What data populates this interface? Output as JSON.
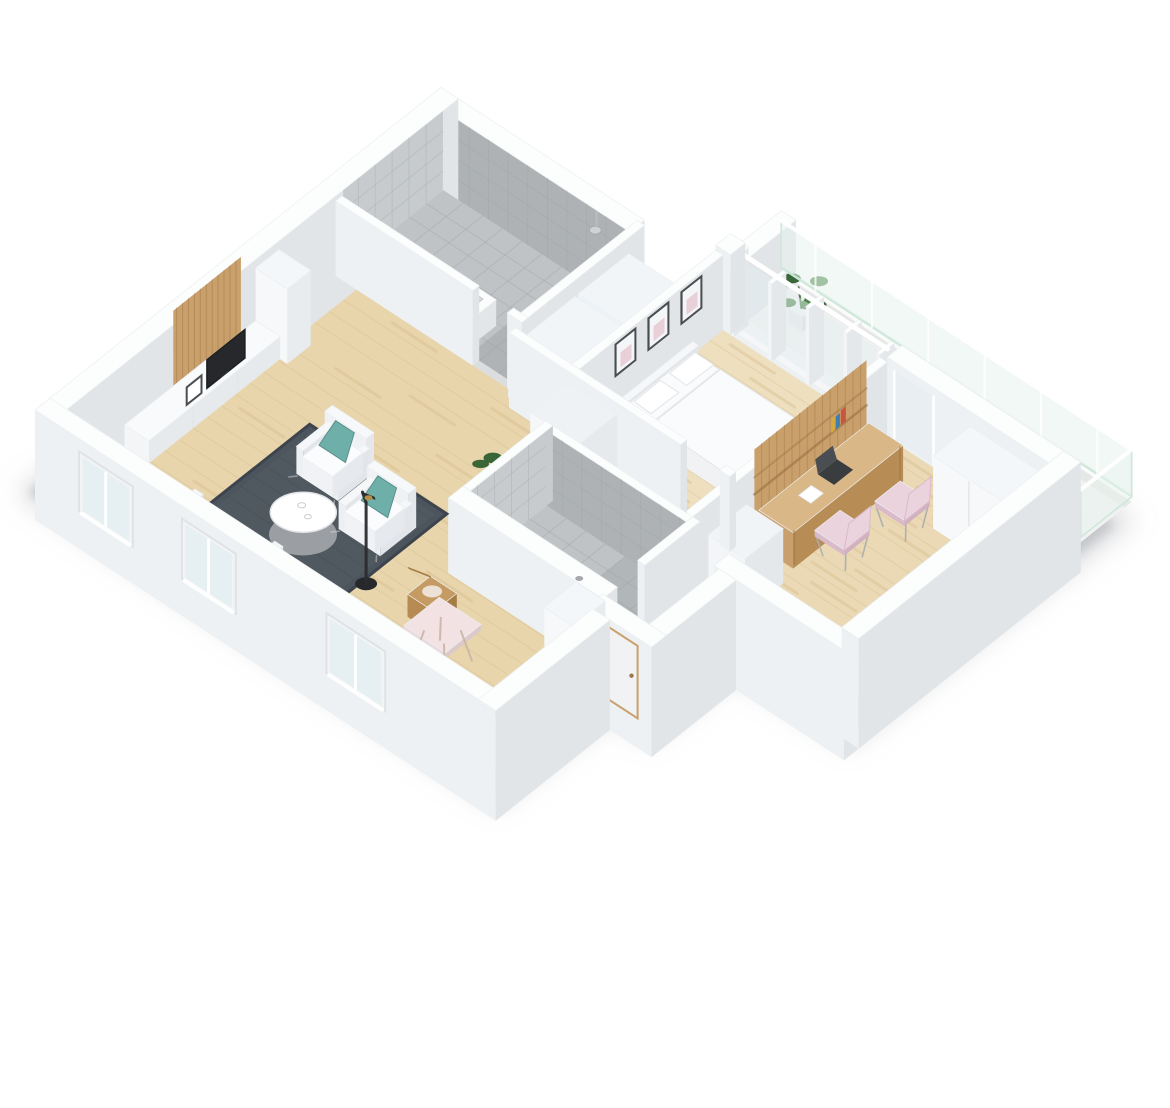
{
  "page": {
    "background": "#ffffff",
    "type": "3d-floor-plan-render",
    "view": "isometric dollhouse cutaway, white exterior walls, no text",
    "subject": "3D isometric floor plan render of a one-bedroom apartment with balcony"
  },
  "palette": {
    "wallTop": "#fcfdfd",
    "wallFrontLight": "#f7f8f9",
    "wallFront": "#eef1f3",
    "wallSide": "#e1e5e8",
    "wallDeep": "#d4d8db",
    "woodBedroom": "#eedfbf",
    "woodOffice": "#ebd9b5",
    "woodHall": "#e9d5ac",
    "woodNook": "#f2e8d0",
    "plankSeam": "#d8c194",
    "plankStreak": "#d2b684",
    "tileFloor": "#bfc3c5",
    "tileFloorDark": "#a9adaf",
    "tileWall": "#c7cbcd",
    "tileWallDark": "#aeb2b4",
    "tileLine": "#9c9fa1",
    "balconyFloor": "#f0f1f0",
    "glass": "#e8f3ee",
    "glassEdge": "#cde7d8",
    "windowGlass": "#e4edf0",
    "rug": "#4c545d",
    "rugDark": "#3d444d",
    "rugLight": "#5b636c",
    "teal": "#6fafa9",
    "tealDark": "#588f8a",
    "mint": "#d9ecdc",
    "paleBlue": "#cfe0ea",
    "pink": "#ebd3dd",
    "pinkShade": "#d9bac9",
    "oak": "#c9a06b",
    "oakDark": "#9e7847",
    "oakLight": "#d9b787",
    "chairWood": "#c59a63",
    "chairWoodDark": "#a57c44",
    "white": "#ffffff",
    "softWhite": "#f4f6f7",
    "bedTop": "#fafbfc",
    "bedShade": "#e9ebef",
    "linen": "#f1f2f4",
    "dark": "#26282b",
    "charcoal": "#3a3d40",
    "brass": "#b98f45",
    "cooktop": "#5d6165",
    "plant": "#44813f",
    "plantDark": "#2e6030",
    "plantStem": "#3c6d38",
    "pot": "#f3f4f4",
    "shadow": "#a7abb0",
    "frameBorder": "#4a4d50",
    "artPink": "#e5c6cf"
  },
  "rooms": [
    {
      "id": "balcony",
      "label": "Balcony",
      "floor": "white concrete"
    },
    {
      "id": "bedroom",
      "label": "Bedroom",
      "floor": "light wood"
    },
    {
      "id": "office",
      "label": "Home office",
      "floor": "light wood"
    },
    {
      "id": "bathroom",
      "label": "Bathroom",
      "floor": "gray tile"
    },
    {
      "id": "shower-room",
      "label": "Shower room",
      "floor": "gray tile"
    },
    {
      "id": "hallway",
      "label": "Hallway",
      "floor": "light wood"
    },
    {
      "id": "closet-nook",
      "label": "Closet nook",
      "floor": "light wood"
    },
    {
      "id": "living-room",
      "label": "Living room",
      "floor": "light wood"
    },
    {
      "id": "kitchen-dining",
      "label": "Kitchen / dining",
      "floor": "light wood"
    },
    {
      "id": "entry-corridor",
      "label": "Entry corridor",
      "floor": "light wood"
    }
  ],
  "furnishings": {
    "balcony": [
      "glass-railing",
      "potted-plant"
    ],
    "bedroom": [
      "double-bed",
      "white-duvet",
      "pillows",
      "wall-frames",
      "window-wall"
    ],
    "office": [
      "wood-desk",
      "slat-shelf-panel",
      "pink-chair",
      "pink-chair",
      "white-wardrobe",
      "white-cabinet"
    ],
    "bathroom": [
      "shower-head",
      "vanity-basin",
      "toilet"
    ],
    "hallway": [
      "tall-wardrobe",
      "potted-plant"
    ],
    "living-room": [
      "tv-sideboard",
      "slat-tv-panel",
      "tv",
      "photo-frame",
      "charcoal-rug",
      "armchair-teal-cushion",
      "armchair-teal-cushion",
      "round-coffee-table",
      "black-floor-lamp",
      "sofa-mint-throw"
    ],
    "kitchen-dining": [
      "tall-fridge-column",
      "counter-run",
      "cooktop",
      "sink",
      "dining-table",
      "wood-chair",
      "wood-chair"
    ]
  },
  "counts": {
    "wall_frames": 3,
    "teal_cushions": 2,
    "pink_desk_chairs": 2,
    "dining_chairs": 2,
    "facade_windows": 3,
    "bedroom_window_panes": 4,
    "plants": 2
  }
}
